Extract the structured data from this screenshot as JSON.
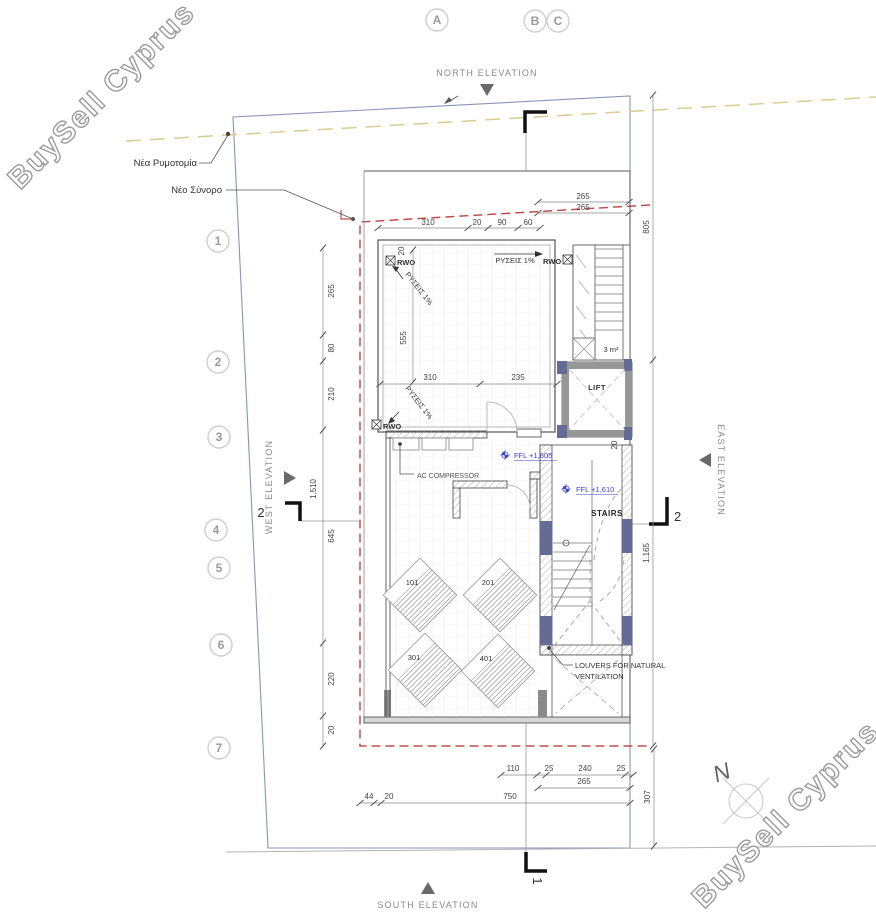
{
  "watermark": "BuySell Cyprus",
  "grid": {
    "letters": [
      "A",
      "B",
      "C"
    ],
    "numbers": [
      "1",
      "2",
      "3",
      "4",
      "5",
      "6",
      "7"
    ]
  },
  "elevations": {
    "north": "NORTH ELEVATION",
    "south": "SOUTH ELEVATION",
    "west": "WEST ELEVATION",
    "east": "EAST ELEVATION"
  },
  "site": {
    "new_street": "Νέα Ρυμοτομία",
    "new_boundary": "Νέο Σύνορο",
    "north": "N"
  },
  "rooms": {
    "lift": "LIFT",
    "stairs": "STAIRS",
    "area": "3 m²",
    "ac": "AC COMPRESSOR",
    "louvers1": "LOUVERS FOR NATURAL",
    "louvers2": "VENTILATION"
  },
  "levels": {
    "ffl1": "FFL +1,605",
    "ffl2": "FFL +1,610"
  },
  "roof": {
    "rwo": "RWO",
    "slope": "ΡΥΣΕΙΣ 1%"
  },
  "units": [
    "101",
    "201",
    "301",
    "401"
  ],
  "sections": {
    "s1": "1",
    "s2": "2"
  },
  "colors": {
    "lot_line": "#8a94ba",
    "boundary_red": "#c0504d",
    "street_yellow": "#d8cc92",
    "level_blue": "#3a46c0"
  },
  "dims": {
    "top_chain": [
      "310",
      "20",
      "90",
      "60"
    ],
    "top_right": [
      "265",
      "265"
    ],
    "left_chain": [
      "265",
      "80",
      "210",
      "645",
      "220",
      "20"
    ],
    "left_total": "1.510",
    "inner": {
      "h555": "555",
      "w310": "310",
      "w235": "235",
      "t20a": "20",
      "t20b": "20"
    },
    "right": {
      "d805": "805",
      "d1165": "1.165",
      "d307": "307"
    },
    "bottom1": [
      "110",
      "25",
      "240",
      "25"
    ],
    "bottom2": "265",
    "bottom3": [
      "44",
      "20",
      "750"
    ]
  }
}
